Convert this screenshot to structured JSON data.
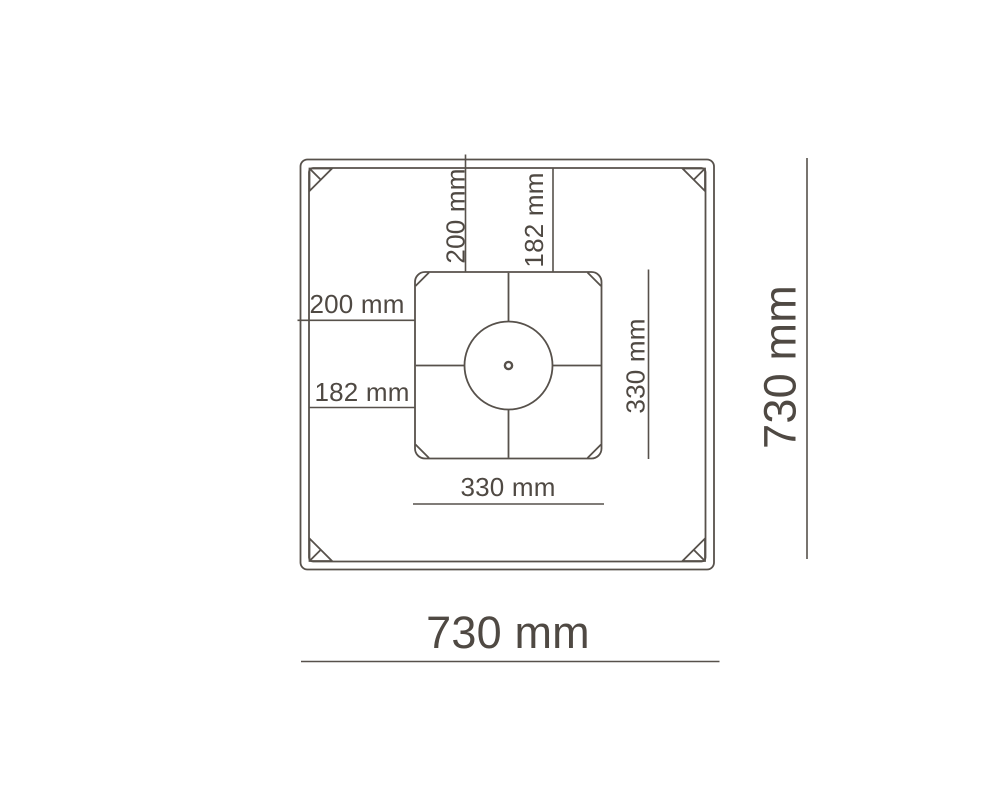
{
  "diagram": {
    "type": "technical-dimension-drawing",
    "subject": "square plate top view with centered mounting square and hub circle",
    "colors": {
      "line": "#57514B",
      "text": "#4F4943",
      "background": "#FFFFFF"
    },
    "labels": {
      "top_outer_offset": "200 mm",
      "top_inner_offset": "182 mm",
      "left_outer_offset": "200 mm",
      "left_inner_offset": "182 mm",
      "inner_square_height": "330 mm",
      "inner_square_width": "330 mm",
      "outer_square_height": "730 mm",
      "outer_square_width": "730 mm"
    }
  }
}
